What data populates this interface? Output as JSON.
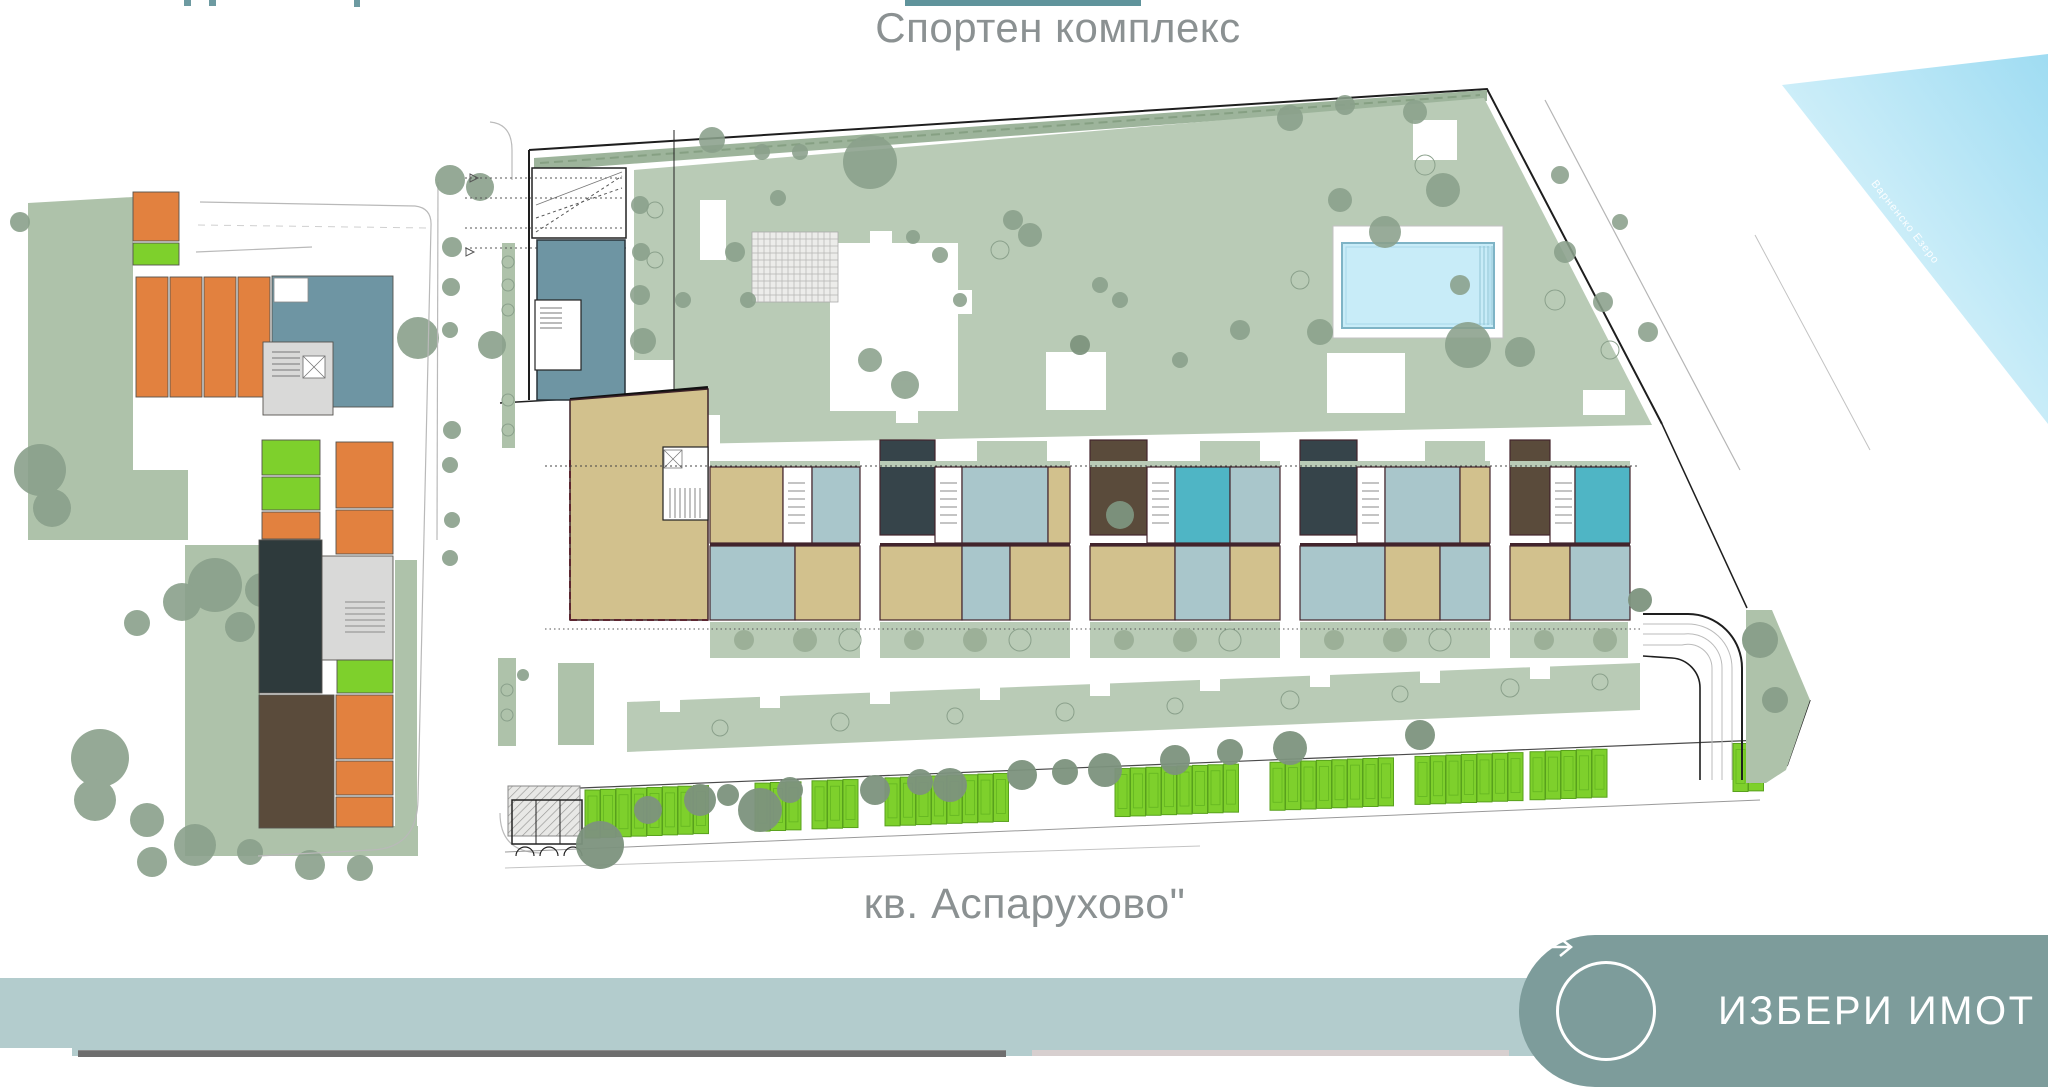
{
  "header": {
    "title": "Спортен комплекс"
  },
  "footer": {
    "label": "кв. Аспарухово\""
  },
  "ribbon": {
    "label": "Варненско Езеро"
  },
  "cta": {
    "label": "ИЗБЕРИ ИМОТ",
    "icon": "arrow-right-icon"
  },
  "palette": {
    "titleGray": "#8b9192",
    "ctaGreen": "#7d9c9b",
    "bandBlue": "#b3cccd",
    "barGray": "#6e6e6e",
    "barPink": "#d7cfcf",
    "navTeal": "#5f939b",
    "ribbonBlue": "#a9e1f4",
    "poolWater": "#c8ecf8",
    "orange": "#e2813f",
    "chartreuse": "#7ed02c",
    "chartreuseEdge": "#58a11c",
    "beige": "#d2c18d",
    "unitBlue": "#a9c6cb",
    "teal": "#4fb5c5",
    "darkSlate": "#36444a",
    "brown": "#5a4b3b",
    "blueGray": "#6e95a3",
    "sagePark": "#aec2aa",
    "sageCourt": "#b9cbb6",
    "sageHedge": "#9db49b",
    "sageTree": "#8aa08b",
    "wall": "#42242c",
    "white": "#ffffff",
    "grayCore": "#d9d9d8",
    "darkUnit": "#2e3a3c"
  },
  "plan": {
    "building_cells": [
      [
        880,
        440,
        55,
        95,
        "darkSlate"
      ],
      [
        1090,
        440,
        57,
        95,
        "brown"
      ],
      [
        1300,
        440,
        57,
        95,
        "darkSlate"
      ],
      [
        1510,
        440,
        40,
        95,
        "brown"
      ],
      [
        977,
        441,
        70,
        25,
        "sageCourt"
      ],
      [
        1200,
        441,
        60,
        25,
        "sageCourt"
      ],
      [
        1425,
        441,
        60,
        25,
        "sageCourt"
      ],
      [
        710,
        461,
        150,
        6,
        "sageCourt"
      ],
      [
        880,
        461,
        190,
        6,
        "sageCourt"
      ],
      [
        1090,
        461,
        190,
        6,
        "sageCourt"
      ],
      [
        1300,
        461,
        190,
        6,
        "sageCourt"
      ],
      [
        1510,
        461,
        120,
        6,
        "sageCourt"
      ],
      [
        710,
        467,
        73,
        76,
        "beige"
      ],
      [
        783,
        467,
        29,
        76,
        "white"
      ],
      [
        812,
        467,
        48,
        76,
        "unitBlue"
      ],
      [
        935,
        467,
        27,
        76,
        "white"
      ],
      [
        962,
        467,
        86,
        76,
        "unitBlue"
      ],
      [
        1048,
        467,
        22,
        76,
        "beige"
      ],
      [
        1147,
        467,
        28,
        76,
        "white"
      ],
      [
        1175,
        467,
        55,
        76,
        "teal"
      ],
      [
        1230,
        467,
        50,
        76,
        "unitBlue"
      ],
      [
        1357,
        467,
        28,
        76,
        "white"
      ],
      [
        1385,
        467,
        75,
        76,
        "unitBlue"
      ],
      [
        1460,
        467,
        30,
        76,
        "beige"
      ],
      [
        1550,
        467,
        25,
        76,
        "white"
      ],
      [
        1575,
        467,
        55,
        76,
        "teal"
      ],
      [
        710,
        543,
        150,
        3,
        "wall"
      ],
      [
        880,
        543,
        190,
        3,
        "wall"
      ],
      [
        1090,
        543,
        190,
        3,
        "wall"
      ],
      [
        1300,
        543,
        190,
        3,
        "wall"
      ],
      [
        1510,
        543,
        120,
        3,
        "wall"
      ],
      [
        710,
        546,
        85,
        74,
        "unitBlue"
      ],
      [
        795,
        546,
        65,
        74,
        "beige"
      ],
      [
        880,
        546,
        82,
        74,
        "beige"
      ],
      [
        962,
        546,
        48,
        74,
        "unitBlue"
      ],
      [
        1010,
        546,
        60,
        74,
        "beige"
      ],
      [
        1090,
        546,
        85,
        74,
        "beige"
      ],
      [
        1175,
        546,
        55,
        74,
        "unitBlue"
      ],
      [
        1230,
        546,
        50,
        74,
        "beige"
      ],
      [
        1300,
        546,
        85,
        74,
        "unitBlue"
      ],
      [
        1385,
        546,
        55,
        74,
        "beige"
      ],
      [
        1440,
        546,
        50,
        74,
        "unitBlue"
      ],
      [
        1510,
        546,
        60,
        74,
        "beige"
      ],
      [
        1570,
        546,
        60,
        74,
        "unitBlue"
      ],
      [
        710,
        622,
        150,
        36,
        "sageCourt"
      ],
      [
        880,
        622,
        190,
        36,
        "sageCourt"
      ],
      [
        1090,
        622,
        190,
        36,
        "sageCourt"
      ],
      [
        1300,
        622,
        190,
        36,
        "sageCourt"
      ],
      [
        1510,
        622,
        118,
        36,
        "sageCourt"
      ]
    ],
    "left_units": [
      [
        133,
        192,
        46,
        49,
        "orange"
      ],
      [
        133,
        243,
        46,
        22,
        "chartreuse"
      ],
      [
        136,
        277,
        32,
        120,
        "orange"
      ],
      [
        170,
        277,
        32,
        120,
        "orange"
      ],
      [
        204,
        277,
        32,
        120,
        "orange"
      ],
      [
        238,
        277,
        32,
        120,
        "orange"
      ],
      [
        272,
        276,
        121,
        131,
        "blueGray"
      ],
      [
        263,
        342,
        70,
        73,
        "grayCore"
      ],
      [
        262,
        440,
        58,
        35,
        "chartreuse"
      ],
      [
        262,
        477,
        58,
        33,
        "chartreuse"
      ],
      [
        262,
        512,
        58,
        27,
        "orange"
      ],
      [
        336,
        442,
        57,
        66,
        "orange"
      ],
      [
        336,
        510,
        57,
        44,
        "orange"
      ],
      [
        259,
        540,
        63,
        153,
        "darkUnit"
      ],
      [
        322,
        556,
        71,
        104,
        "grayCore"
      ],
      [
        337,
        660,
        56,
        33,
        "chartreuse"
      ],
      [
        259,
        695,
        75,
        133,
        "brown"
      ],
      [
        336,
        695,
        57,
        64,
        "orange"
      ],
      [
        336,
        761,
        57,
        34,
        "orange"
      ],
      [
        336,
        797,
        57,
        30,
        "orange"
      ]
    ],
    "parking": {
      "stall_w": 15,
      "stall_h": 48,
      "pitch": 15.5,
      "x0": 585,
      "y0": 790,
      "slope": -0.0405,
      "groups": [
        {
          "x": 585,
          "count": 8
        },
        {
          "x": 755,
          "count": 3
        },
        {
          "x": 812,
          "count": 3
        },
        {
          "x": 885,
          "count": 8
        },
        {
          "x": 1115,
          "count": 8
        },
        {
          "x": 1270,
          "count": 8
        },
        {
          "x": 1415,
          "count": 7
        },
        {
          "x": 1530,
          "count": 5
        },
        {
          "x": 1733,
          "count": 2
        }
      ]
    }
  }
}
